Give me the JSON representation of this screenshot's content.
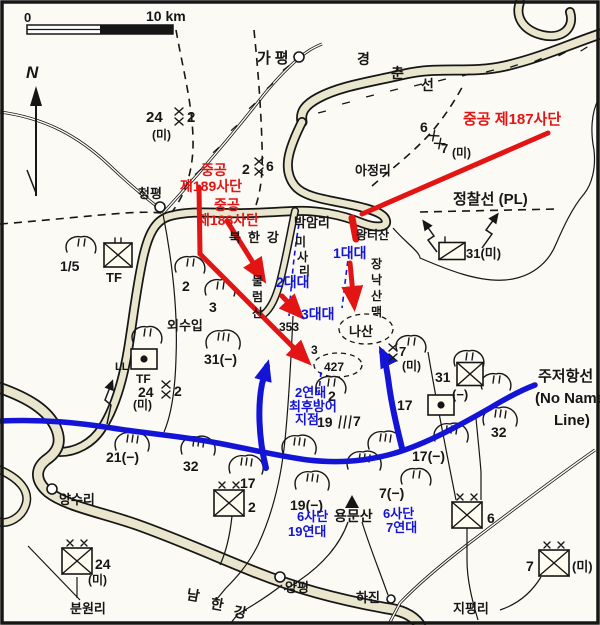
{
  "colors": {
    "red": "#e31414",
    "blue": "#1414d6",
    "river": "#e9e6cd",
    "ink": "#161616",
    "bg": "#fbfaf5"
  },
  "scale": {
    "zero": "0",
    "label": "10 km"
  },
  "compass": {
    "n": "N"
  },
  "red_labels": {
    "div187": "중공 제187사단",
    "div189_1": "중공",
    "div189_2": "제189사단",
    "div188_1": "중공",
    "div188_2": "제188사단"
  },
  "blue_labels": {
    "bn1": "1대대",
    "bn2": "2대대",
    "bn3": "3대대",
    "reg2_1": "2연대",
    "reg2_2": "최후방어",
    "reg2_3": "지점",
    "d6r19_1": "6사단",
    "d6r19_2": "19연대",
    "d6r7_1": "6사단",
    "d6r7_2": "7연대"
  },
  "places": {
    "gapyeong": "가평",
    "gyeongchun": "경춘선",
    "cheongpyeong": "청평",
    "ajeongni": "아정리",
    "bakamni": "박암리",
    "wangteosan": "왕터산",
    "oesuip": "외수입",
    "bukhangang": "북한강",
    "misari": "미사리",
    "jangnak": "장낙산맥",
    "mulleomsan": "물럼산",
    "nasan": "나산",
    "yongmunsan": "용문산",
    "yangpyeong": "양평",
    "hajin": "하진",
    "jipyeongni": "지평리",
    "bunwonni": "분원리",
    "yangsuri": "양수리",
    "namhangang": "남한강"
  },
  "lines": {
    "pl": "정찰선 (PL)",
    "msr": "주저항선",
    "msr_en1": "(No Name",
    "msr_en2": "Line)"
  },
  "boundaries": {
    "b24": "24",
    "b24_2": "2",
    "b24_mi": "(미)",
    "b2": "2",
    "b2_6": "6",
    "b6": "6",
    "b6_7": "7",
    "b6_mi": "(미)",
    "b19": "19",
    "b19_7": "7",
    "b7": "7",
    "b7_mi": "(미)"
  },
  "units": {
    "tf15": "1/5",
    "tf15_tf": "TF",
    "tf24_marks": "LL",
    "tf24_tf": "TF",
    "tf24": "24",
    "tf24_2": "2",
    "tf24_mi": "(미)",
    "armor31": "31(미)",
    "u31": "31",
    "u31_m": "(−)",
    "u17": "17",
    "div2": "2",
    "div6": "6",
    "div7": "7",
    "div7_mi": "(미)",
    "div24": "24",
    "div24_mi": "(미)"
  },
  "hills": {
    "h2": "2",
    "h3": "3",
    "h31": "31(−)",
    "h2b": "2",
    "h17w": "17",
    "h21": "21(−)",
    "h32w": "32",
    "h32e": "32",
    "h17e": "17(−)",
    "h19": "19(−)",
    "h7": "7(−)"
  },
  "heights": {
    "p353": "353",
    "p3": "3",
    "p427": "427"
  }
}
